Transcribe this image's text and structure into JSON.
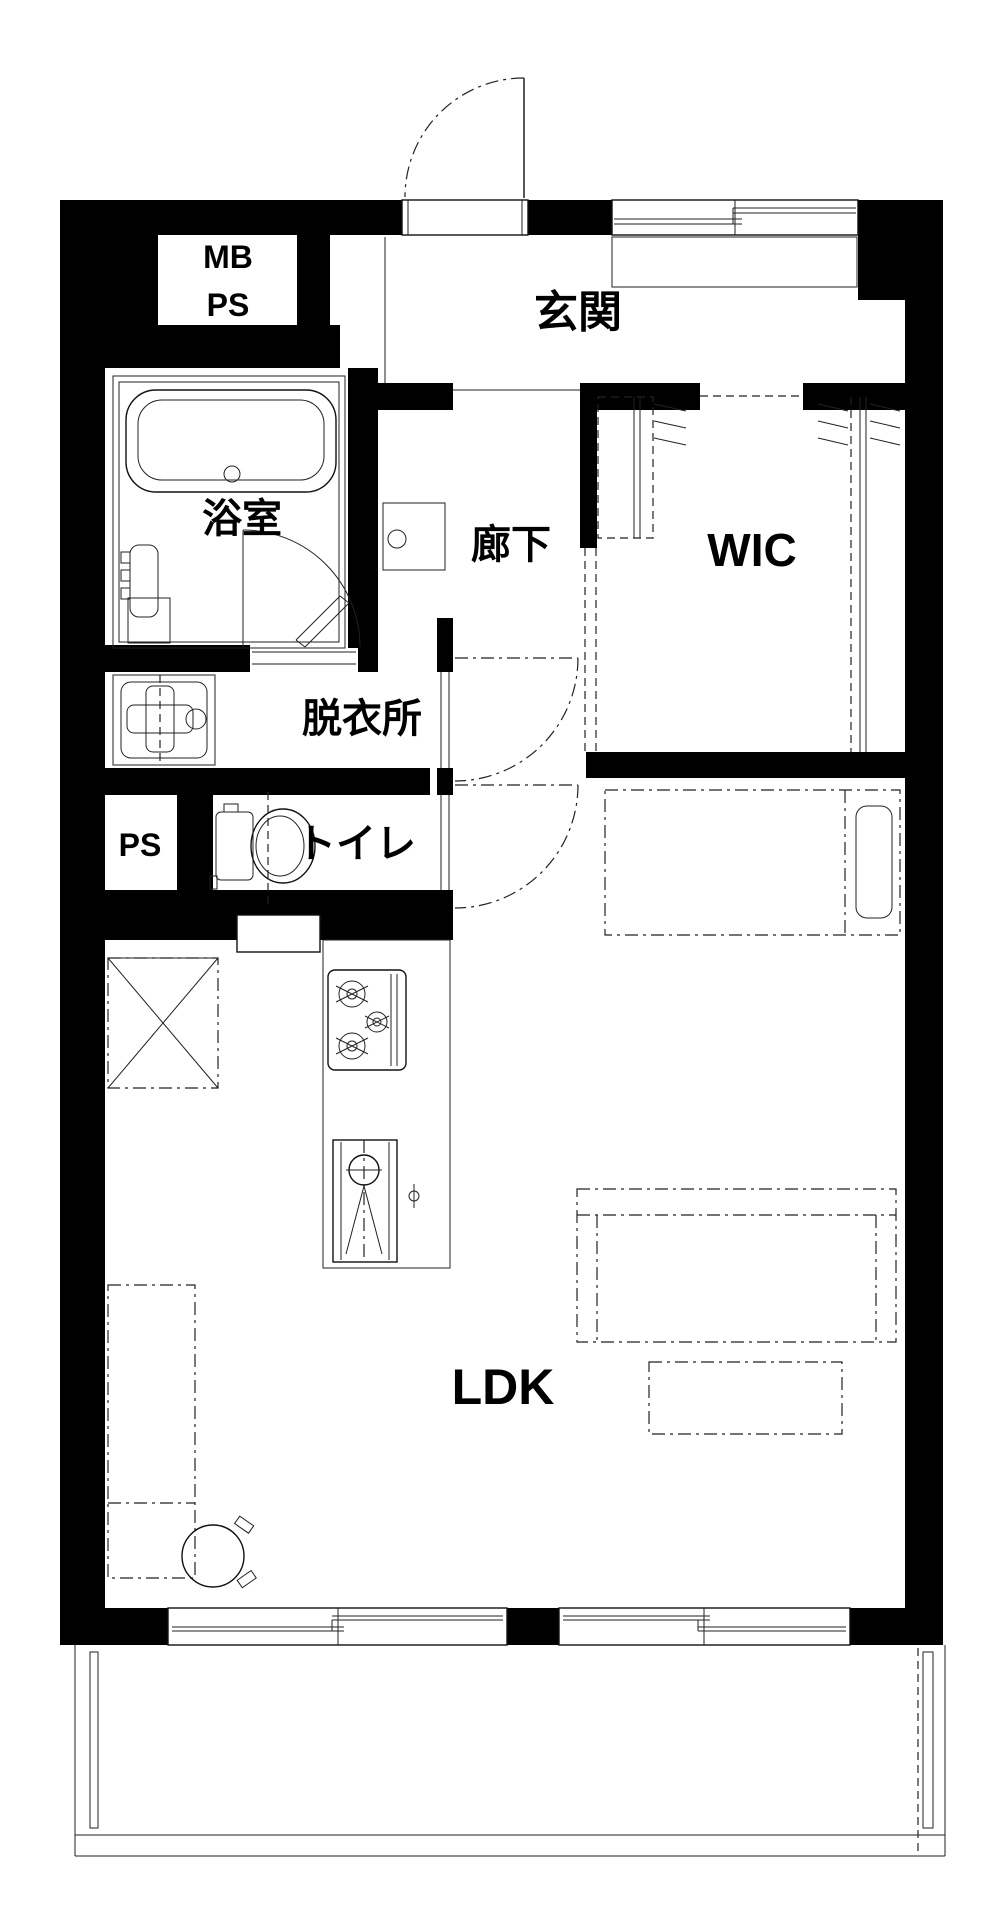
{
  "title": "1LDK apartment floor plan",
  "colors": {
    "wall": "#000000",
    "line": "#111111",
    "background": "#ffffff"
  },
  "rooms": {
    "entrance": "玄関",
    "hallway": "廊下",
    "bathroom": "浴室",
    "dressing_room": "脱衣所",
    "toilet": "トイレ",
    "walk_in_closet": "WIC",
    "living_dining_kitchen": "LDK",
    "meter_box": "MB",
    "pipe_space_top": "PS",
    "pipe_space_side": "PS"
  },
  "fixtures": [
    "entrance-door-swing-icon",
    "shoe-cabinet-icon",
    "bathtub-icon",
    "bath-door-swing-icon",
    "shower-faucet-icon",
    "washbasin-icon",
    "washing-machine-pan-icon",
    "toilet-icon",
    "gas-stove-3-burner-icon",
    "kitchen-sink-icon",
    "refrigerator-space-icon",
    "hanger-pipe-icon",
    "single-bed-icon",
    "sofa-icon",
    "low-table-icon",
    "tv-board-icon",
    "round-stool-icon",
    "sliding-window-icon",
    "balcony-partition-icon"
  ]
}
